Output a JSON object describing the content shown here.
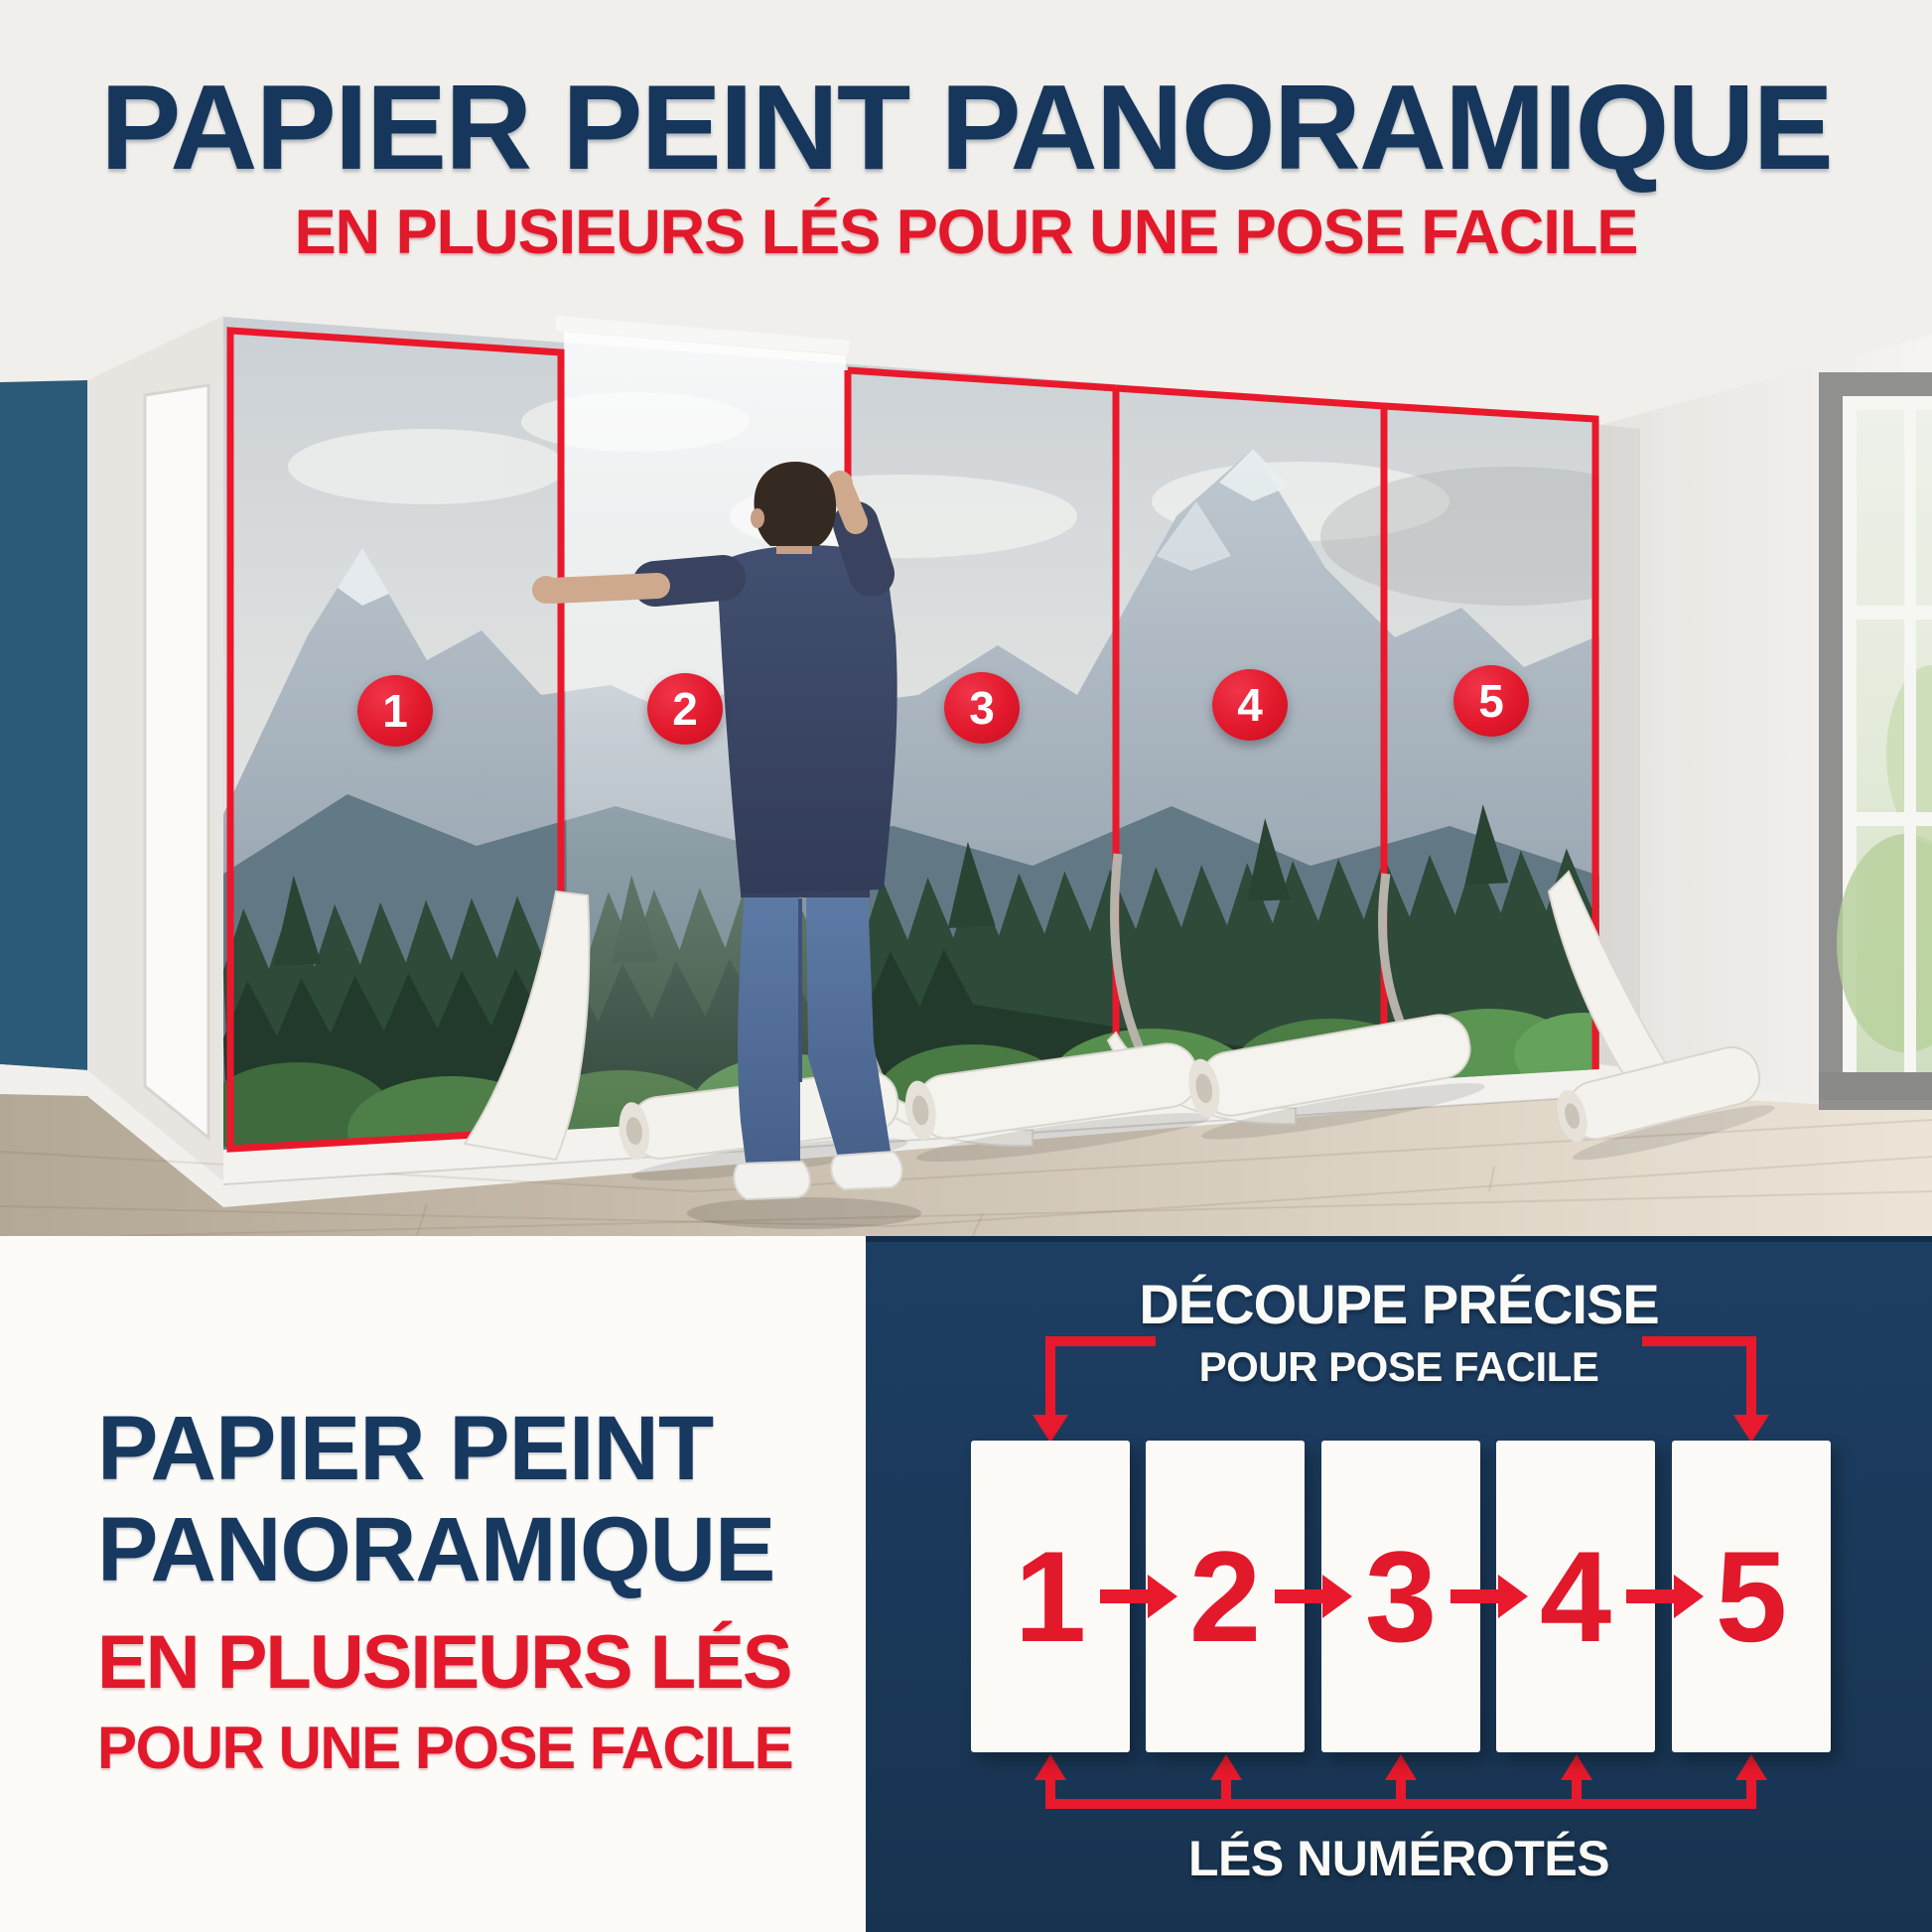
{
  "header": {
    "title": "PAPIER PEINT PANORAMIQUE",
    "subtitle": "EN PLUSIEURS LÉS POUR UNE POSE FACILE"
  },
  "photo": {
    "strips": [
      {
        "number": "1"
      },
      {
        "number": "2"
      },
      {
        "number": "3"
      },
      {
        "number": "4"
      },
      {
        "number": "5"
      }
    ]
  },
  "bottom_left": {
    "title_line1": "PAPIER PEINT",
    "title_line2": "PANORAMIQUE",
    "subtitle_line1": "EN PLUSIEURS LÉS",
    "subtitle_line2": "POUR UNE POSE FACILE"
  },
  "diagram": {
    "heading_line1": "DÉCOUPE PRÉCISE",
    "heading_line2": "POUR POSE FACILE",
    "strips": [
      {
        "number": "1"
      },
      {
        "number": "2"
      },
      {
        "number": "3"
      },
      {
        "number": "4"
      },
      {
        "number": "5"
      }
    ],
    "footer_label": "LÉS NUMÉROTÉS"
  },
  "colors": {
    "navy_text": "#16365c",
    "red": "#e2182b",
    "panel_navy": "#1b3a5c",
    "accent_wall": "#2b5a78"
  }
}
